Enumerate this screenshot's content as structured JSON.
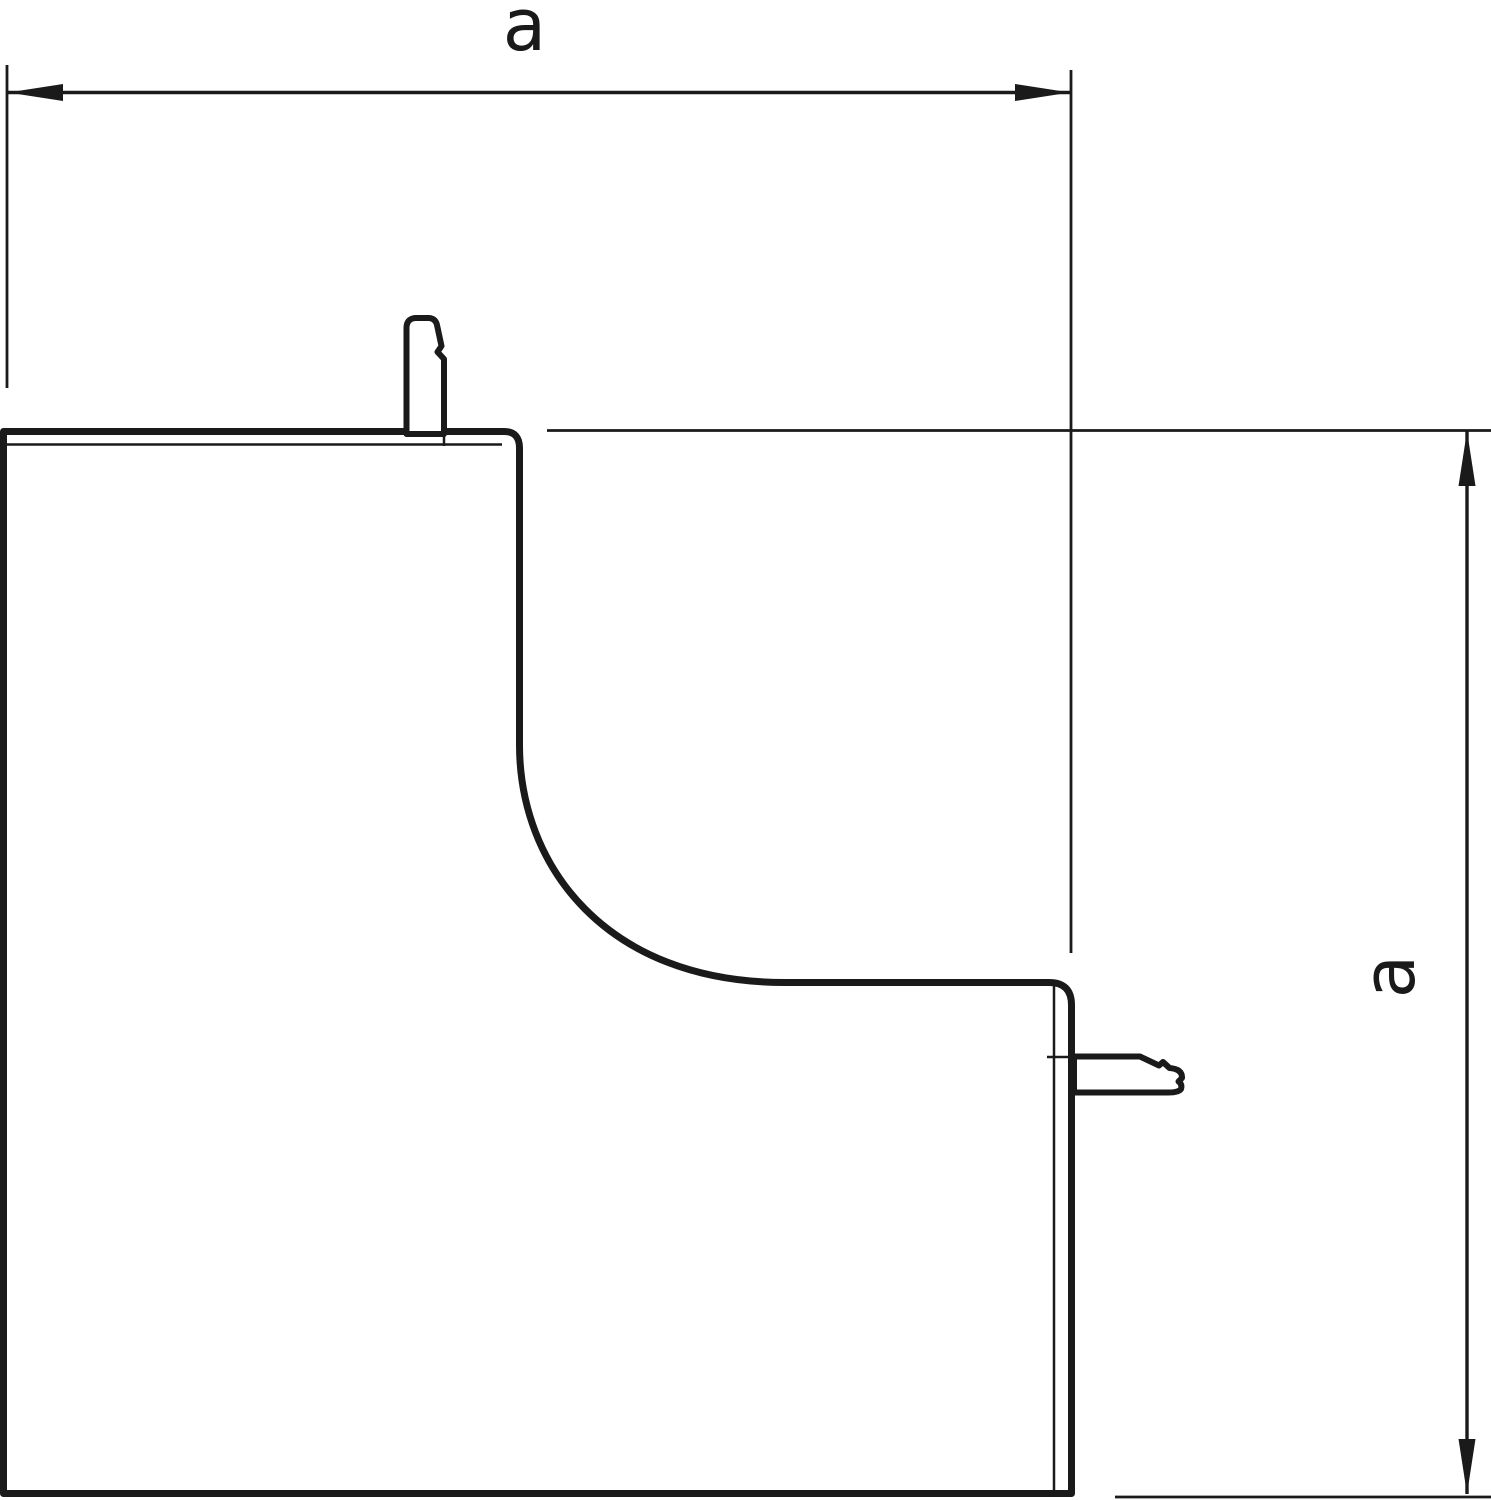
{
  "drawing": {
    "dimension_width": {
      "label": "a"
    },
    "dimension_height": {
      "label": "a"
    },
    "colors": {
      "line": "#1a1a1a",
      "background": "#ffffff"
    }
  }
}
